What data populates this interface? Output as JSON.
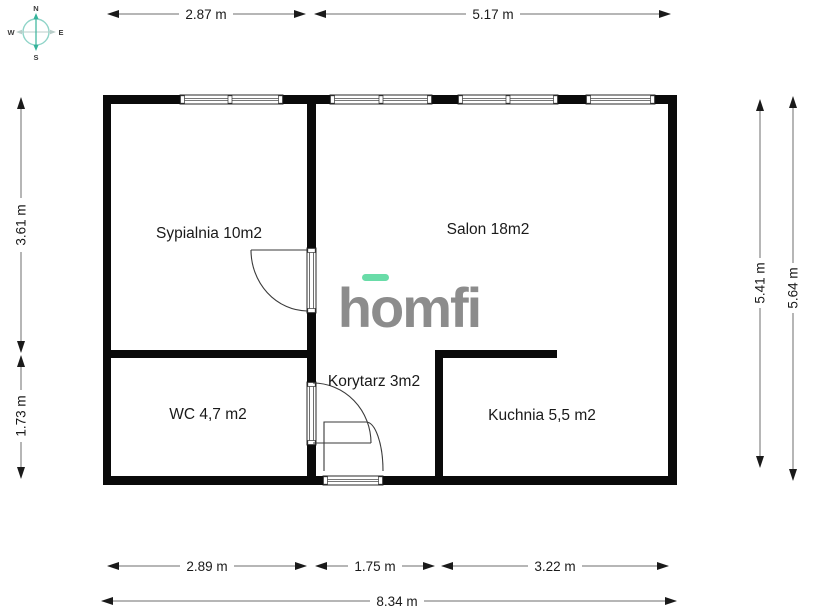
{
  "plan": {
    "type": "floor-plan",
    "watermark": "homfi"
  },
  "compass": {
    "north": "N",
    "south": "S",
    "west": "W",
    "east": "E"
  },
  "logo": {
    "text": "homfi"
  },
  "rooms": [
    {
      "id": "sypialnia",
      "label": "Sypialnia 10m2"
    },
    {
      "id": "salon",
      "label": "Salon 18m2"
    },
    {
      "id": "wc",
      "label": "WC 4,7 m2"
    },
    {
      "id": "korytarz",
      "label": "Korytarz 3m2"
    },
    {
      "id": "kuchnia",
      "label": "Kuchnia 5,5 m2"
    }
  ],
  "dimensions": {
    "top": [
      {
        "label": "2.87 m"
      },
      {
        "label": "5.17 m"
      }
    ],
    "left": [
      {
        "label": "3.61 m"
      },
      {
        "label": "1.73 m"
      }
    ],
    "right": [
      {
        "label": "5.41 m"
      },
      {
        "label": "5.64 m"
      }
    ],
    "bottom": [
      {
        "label": "2.89 m"
      },
      {
        "label": "1.75 m"
      },
      {
        "label": "3.22 m"
      }
    ],
    "overall": {
      "label": "8.34 m"
    }
  },
  "colors": {
    "wall": "#0a0a0a",
    "accent_green": "#69dca8",
    "logo_gray": "#8c8c8c",
    "compass_teal": "#35b39a"
  }
}
